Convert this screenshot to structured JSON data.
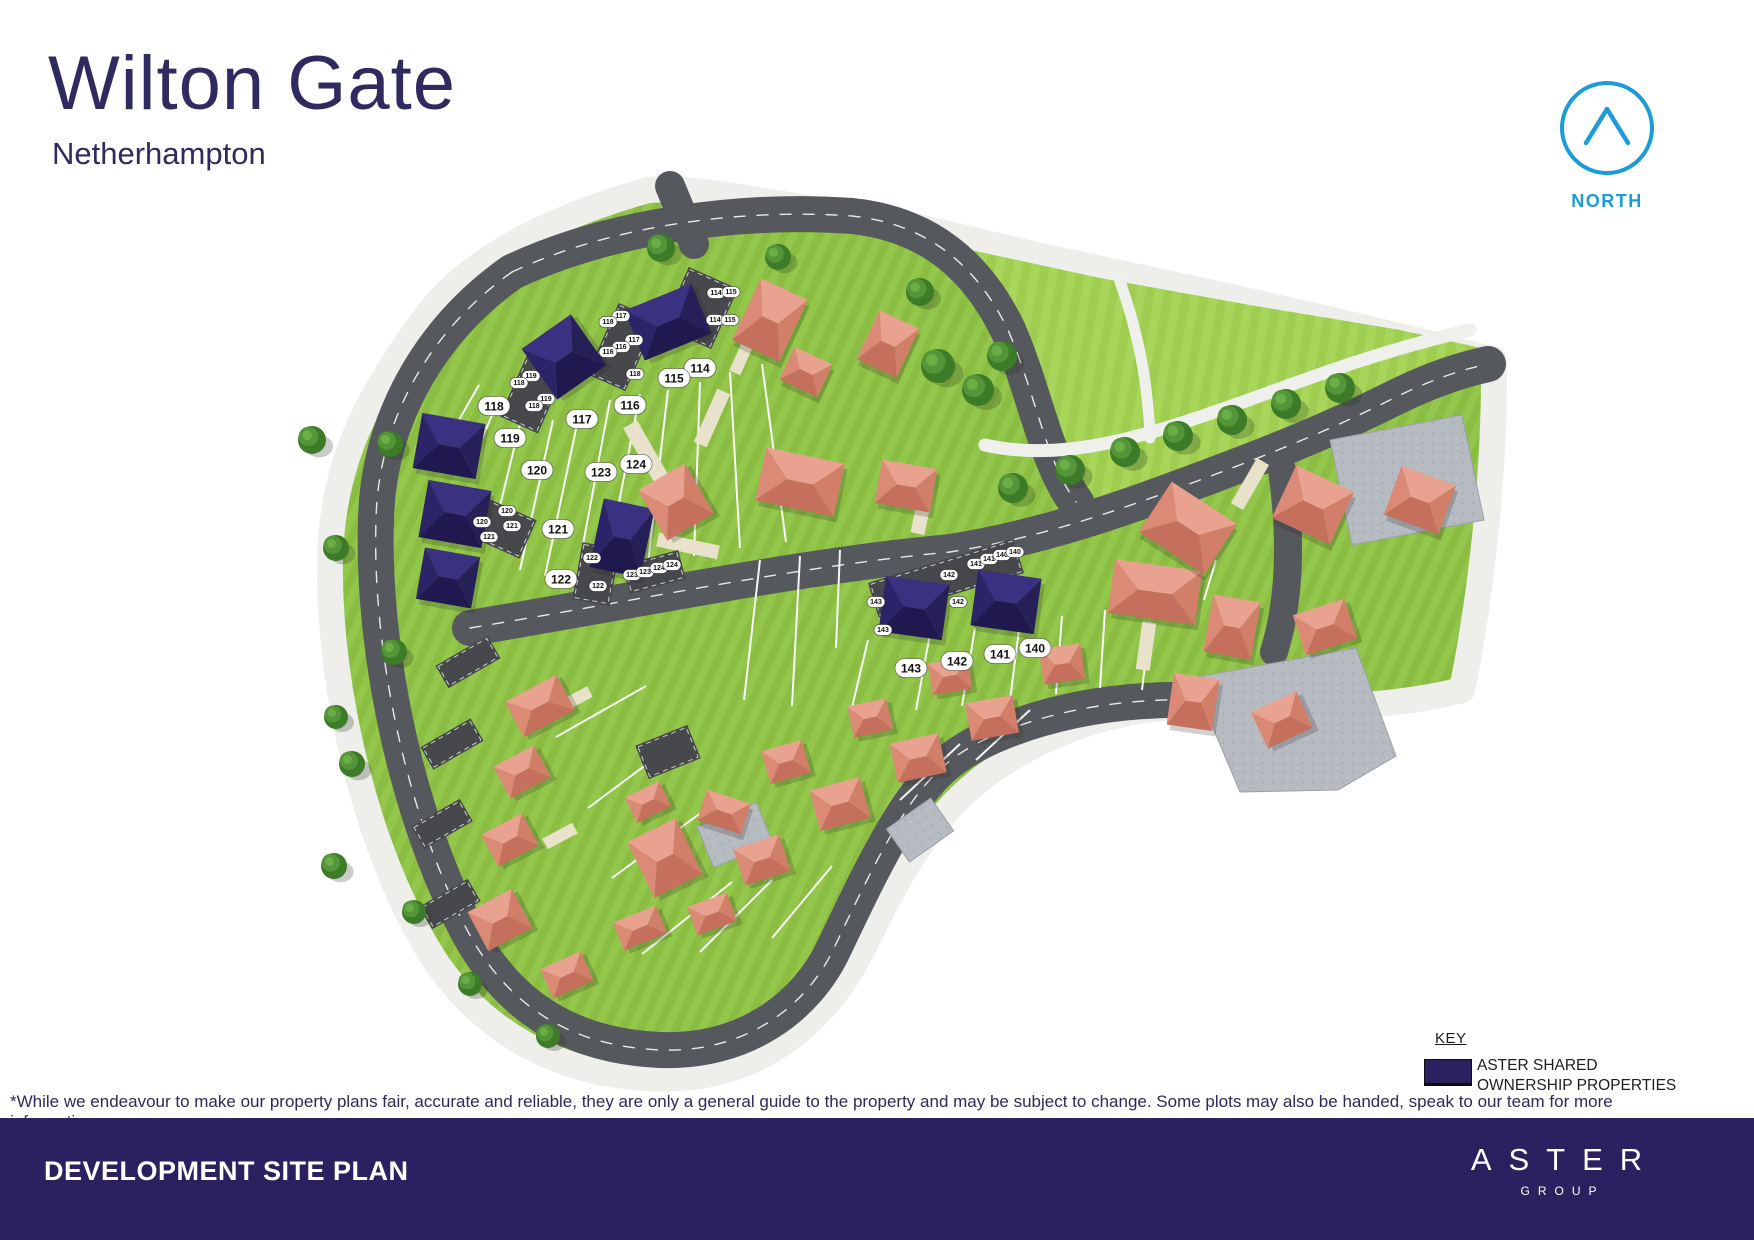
{
  "header": {
    "title": "Wilton Gate",
    "subtitle": "Netherhampton"
  },
  "north": {
    "label": "NORTH",
    "color": "#1b9cd8"
  },
  "key": {
    "title": "KEY",
    "swatch_color": "#2b2161",
    "label_line1": "ASTER SHARED",
    "label_line2": "OWNERSHIP PROPERTIES"
  },
  "disclaimer": "*While we endeavour to make our property plans fair, accurate and reliable, they are only a general guide to the property and may be subject to change. Some plots may also be handed, speak to our team for more information.",
  "footer": {
    "title": "DEVELOPMENT SITE PLAN",
    "brand_name": "ASTER",
    "brand_sub": "GROUP",
    "bar_color": "#2b2161"
  },
  "site_plan": {
    "colors": {
      "shared_ownership_house": "#2b2166",
      "market_house": "#d98875",
      "road": "#55585c",
      "lawn": "#8abd41",
      "open_space": "#9ecd4f",
      "footpath": "#efefec",
      "courtyard": "#b6bbc1",
      "driveway": "#e9e2cb"
    },
    "plot_badges": [
      {
        "n": "114",
        "x": 700,
        "y": 368
      },
      {
        "n": "115",
        "x": 674,
        "y": 378
      },
      {
        "n": "116",
        "x": 630,
        "y": 405
      },
      {
        "n": "117",
        "x": 582,
        "y": 419
      },
      {
        "n": "118",
        "x": 494,
        "y": 406
      },
      {
        "n": "119",
        "x": 510,
        "y": 438
      },
      {
        "n": "120",
        "x": 537,
        "y": 470
      },
      {
        "n": "121",
        "x": 558,
        "y": 529
      },
      {
        "n": "122",
        "x": 561,
        "y": 579
      },
      {
        "n": "123",
        "x": 601,
        "y": 472
      },
      {
        "n": "124",
        "x": 636,
        "y": 464
      },
      {
        "n": "140",
        "x": 1035,
        "y": 648
      },
      {
        "n": "141",
        "x": 1000,
        "y": 654
      },
      {
        "n": "142",
        "x": 957,
        "y": 661
      },
      {
        "n": "143",
        "x": 911,
        "y": 668
      }
    ],
    "parking_labels": [
      {
        "n": "114",
        "x": 716,
        "y": 293
      },
      {
        "n": "115",
        "x": 731,
        "y": 292
      },
      {
        "n": "114",
        "x": 715,
        "y": 320
      },
      {
        "n": "115",
        "x": 730,
        "y": 320
      },
      {
        "n": "117",
        "x": 621,
        "y": 316
      },
      {
        "n": "118",
        "x": 608,
        "y": 322
      },
      {
        "n": "117",
        "x": 634,
        "y": 340
      },
      {
        "n": "116",
        "x": 621,
        "y": 347
      },
      {
        "n": "116",
        "x": 608,
        "y": 352
      },
      {
        "n": "118",
        "x": 635,
        "y": 374
      },
      {
        "n": "119",
        "x": 531,
        "y": 376
      },
      {
        "n": "118",
        "x": 519,
        "y": 383
      },
      {
        "n": "119",
        "x": 546,
        "y": 399
      },
      {
        "n": "118",
        "x": 534,
        "y": 406
      },
      {
        "n": "120",
        "x": 507,
        "y": 511
      },
      {
        "n": "120",
        "x": 482,
        "y": 522
      },
      {
        "n": "121",
        "x": 512,
        "y": 526
      },
      {
        "n": "121",
        "x": 489,
        "y": 537
      },
      {
        "n": "122",
        "x": 592,
        "y": 558
      },
      {
        "n": "122",
        "x": 598,
        "y": 586
      },
      {
        "n": "123",
        "x": 632,
        "y": 575
      },
      {
        "n": "123",
        "x": 645,
        "y": 572
      },
      {
        "n": "124",
        "x": 659,
        "y": 568
      },
      {
        "n": "124",
        "x": 672,
        "y": 565
      },
      {
        "n": "143",
        "x": 876,
        "y": 602
      },
      {
        "n": "143",
        "x": 883,
        "y": 630
      },
      {
        "n": "142",
        "x": 949,
        "y": 575
      },
      {
        "n": "142",
        "x": 958,
        "y": 602
      },
      {
        "n": "141",
        "x": 976,
        "y": 564
      },
      {
        "n": "141",
        "x": 989,
        "y": 559
      },
      {
        "n": "140",
        "x": 1002,
        "y": 555
      },
      {
        "n": "140",
        "x": 1015,
        "y": 552
      }
    ]
  }
}
